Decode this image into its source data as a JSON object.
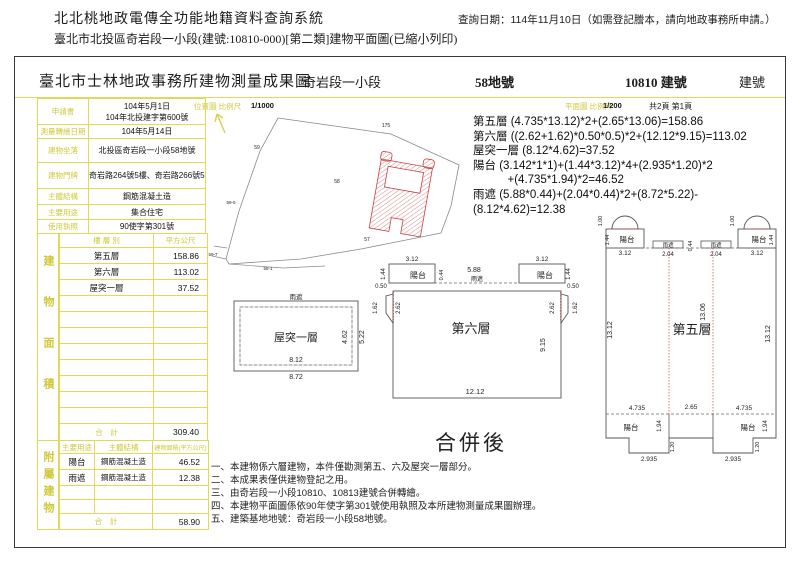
{
  "colors": {
    "accent_yellow": "#e0da5a",
    "label_yellow": "#cfc93a",
    "plan_red": "#c84040",
    "ink": "#1c1c1c"
  },
  "page": {
    "system_title": "北北桃地政電傳全功能地籍資料查詢系統",
    "query_date": "查詢日期：114年11月10日（如需登記謄本，請向地政事務所申請。）",
    "doc_line": "臺北市北投區奇岩段一小段(建號:10810-000)[第二類]建物平面圖(已縮小列印)"
  },
  "sheet": {
    "title": "臺北市士林地政事務所建物測量成果圖",
    "section": "奇岩段一小段",
    "land_no": "58地號",
    "building_no": "10810 建號",
    "building_no2": "建號",
    "scale_map_label": "位置圖 比例尺",
    "scale_map_value": "1/1000",
    "scale_plan_label": "平面圖 比例尺",
    "scale_plan_value": "1/200",
    "page_info": "共2頁 第1頁",
    "north_icon": "north-arrow"
  },
  "info": {
    "rows": [
      {
        "label": "申請書",
        "line1": "104年5月1日",
        "line2": "104年北投建字第600號"
      },
      {
        "label": "測量轉繪日期",
        "value": "104年5月14日"
      },
      {
        "label": "建物坐落",
        "value": "北投區奇岩段一小段58地號"
      },
      {
        "label": "建物門牌",
        "value": "奇岩路264號5樓、奇岩路266號5樓"
      },
      {
        "label": "主體結構",
        "value": "鋼筋混凝土造"
      },
      {
        "label": "主要用途",
        "value": "集合住宅"
      },
      {
        "label": "使用執照",
        "value": "90使字第301號"
      }
    ]
  },
  "area": {
    "side_label": "建物面積",
    "header": [
      "樓 層 別",
      "平方公尺"
    ],
    "rows": [
      [
        "第五層",
        "158.86"
      ],
      [
        "第六層",
        "113.02"
      ],
      [
        "屋突一層",
        "37.52"
      ]
    ],
    "total_label": "合　計",
    "total": "309.40"
  },
  "annex": {
    "side_label": "附屬建物",
    "header": [
      "主要用途",
      "主體結構",
      "建物面積(平方公尺)"
    ],
    "rows": [
      [
        "陽台",
        "鋼筋混凝土造",
        "46.52"
      ],
      [
        "雨遮",
        "鋼筋混凝土造",
        "12.38"
      ]
    ],
    "total_label": "合　計",
    "total": "58.90"
  },
  "formulas": [
    "第五層 (4.735*13.12)*2+(2.65*13.06)=158.86",
    "第六層 ((2.62+1.62)*0.50*0.5)*2+(12.12*9.15)=113.02",
    "屋突一層 (8.12*4.62)=37.52",
    "陽台 (3.142*1*1)+(1.44*3.12)*4+(2.935*1.20)*2",
    "　　　+(4.735*1.94)*2=46.52",
    "雨遮 (5.88*0.44)+(2.04*0.44)*2+(8.72*5.22)-(8.12*4.62)=12.38"
  ],
  "notes": [
    "一、本建物係六層建物，本件僅勘測第五、六及屋突一層部分。",
    "二、本成果表僅供建物登記之用。",
    "三、由奇岩段一小段10810、10813建號合併轉繪。",
    "四、本建物平面圖係依90年使字第301號使用執照及本所建物測量成果圖辦理。",
    "五、建築基地地號：奇岩段一小段58地號。"
  ],
  "merge_label": "合併後",
  "map": {
    "labels": [
      {
        "x": 371,
        "y": 70,
        "t": "175",
        "s": 5
      },
      {
        "x": 242,
        "y": 92,
        "t": "59",
        "s": 5
      },
      {
        "x": 216,
        "y": 147,
        "t": "59-5",
        "s": 4.5
      },
      {
        "x": 198,
        "y": 199,
        "t": "59-7",
        "s": 4.5
      },
      {
        "x": 253,
        "y": 213,
        "t": "58-1",
        "s": 4.5
      },
      {
        "x": 322,
        "y": 126,
        "t": "58",
        "s": 5
      },
      {
        "x": 352,
        "y": 184,
        "t": "57",
        "s": 5
      }
    ]
  },
  "plans": {
    "roof": {
      "labels": [
        {
          "x": 281,
          "y": 242,
          "t": "雨遮",
          "s": 6.5
        },
        {
          "x": 281,
          "y": 284,
          "t": "屋突一層",
          "s": 11
        },
        {
          "x": 281,
          "y": 305,
          "t": "8.12",
          "s": 7
        },
        {
          "x": 281,
          "y": 322,
          "t": "8.72",
          "s": 7
        },
        {
          "x": 332,
          "y": 280,
          "t": "4.62",
          "s": 7,
          "r": -90
        },
        {
          "x": 349,
          "y": 280,
          "t": "5.22",
          "s": 7,
          "r": -90
        }
      ]
    },
    "floor6": {
      "labels": [
        {
          "x": 397,
          "y": 204,
          "t": "3.12",
          "s": 6.5
        },
        {
          "x": 527,
          "y": 204,
          "t": "3.12",
          "s": 6.5
        },
        {
          "x": 403,
          "y": 221,
          "t": "陽台",
          "s": 8
        },
        {
          "x": 530,
          "y": 221,
          "t": "陽台",
          "s": 8
        },
        {
          "x": 370,
          "y": 217,
          "t": "1.44",
          "s": 6,
          "r": -90
        },
        {
          "x": 555,
          "y": 217,
          "t": "1.44",
          "s": 6,
          "r": -90
        },
        {
          "x": 459,
          "y": 215,
          "t": "5.88",
          "s": 7
        },
        {
          "x": 462,
          "y": 224,
          "t": "雨遮",
          "s": 6
        },
        {
          "x": 428,
          "y": 218,
          "t": "0.44",
          "s": 5.5,
          "r": -90
        },
        {
          "x": 366,
          "y": 231,
          "t": "0.50",
          "s": 6
        },
        {
          "x": 558,
          "y": 231,
          "t": "0.50",
          "s": 6
        },
        {
          "x": 362,
          "y": 251,
          "t": "1.62",
          "s": 6,
          "r": -90
        },
        {
          "x": 562,
          "y": 251,
          "t": "1.62",
          "s": 6,
          "r": -90
        },
        {
          "x": 385,
          "y": 251,
          "t": "2.62",
          "s": 6,
          "r": -90
        },
        {
          "x": 539,
          "y": 251,
          "t": "2.62",
          "s": 6,
          "r": -90
        },
        {
          "x": 456,
          "y": 276,
          "t": "第六層",
          "s": 13
        },
        {
          "x": 530,
          "y": 288,
          "t": "9.15",
          "s": 7,
          "r": -90
        },
        {
          "x": 460,
          "y": 337,
          "t": "12.12",
          "s": 7.5
        }
      ]
    },
    "floor5": {
      "labels": [
        {
          "x": 587,
          "y": 164,
          "t": "1.00",
          "s": 5.5,
          "r": -90
        },
        {
          "x": 719,
          "y": 164,
          "t": "1.00",
          "s": 5.5,
          "r": -90
        },
        {
          "x": 612,
          "y": 185,
          "t": "陽台",
          "s": 7.5
        },
        {
          "x": 744,
          "y": 185,
          "t": "陽台",
          "s": 7.5
        },
        {
          "x": 594,
          "y": 183,
          "t": "1.44",
          "s": 5.5,
          "r": -90
        },
        {
          "x": 758,
          "y": 183,
          "t": "1.44",
          "s": 5.5,
          "r": -90
        },
        {
          "x": 610,
          "y": 198,
          "t": "3.12",
          "s": 6.5
        },
        {
          "x": 742,
          "y": 198,
          "t": "3.12",
          "s": 6.5
        },
        {
          "x": 653,
          "y": 190,
          "t": "雨遮",
          "s": 5.5
        },
        {
          "x": 701,
          "y": 190,
          "t": "雨遮",
          "s": 5.5
        },
        {
          "x": 653,
          "y": 199,
          "t": "2.04",
          "s": 6
        },
        {
          "x": 701,
          "y": 199,
          "t": "2.04",
          "s": 6
        },
        {
          "x": 677,
          "y": 189,
          "t": "0.44",
          "s": 5.5,
          "r": -90
        },
        {
          "x": 597,
          "y": 273,
          "t": "13.12",
          "s": 7,
          "r": -90
        },
        {
          "x": 755,
          "y": 277,
          "t": "13.12",
          "s": 7,
          "r": -90
        },
        {
          "x": 690,
          "y": 255,
          "t": "13.06",
          "s": 7,
          "r": -90
        },
        {
          "x": 677,
          "y": 277,
          "t": "第五層",
          "s": 13
        },
        {
          "x": 622,
          "y": 353,
          "t": "4.735",
          "s": 6.5
        },
        {
          "x": 676,
          "y": 352,
          "t": "2.65",
          "s": 6.5
        },
        {
          "x": 729,
          "y": 353,
          "t": "4.735",
          "s": 6.5
        },
        {
          "x": 616,
          "y": 373,
          "t": "陽台",
          "s": 7.5
        },
        {
          "x": 733,
          "y": 373,
          "t": "陽台",
          "s": 7.5
        },
        {
          "x": 646,
          "y": 369,
          "t": "1.94",
          "s": 6,
          "r": -90
        },
        {
          "x": 752,
          "y": 369,
          "t": "1.94",
          "s": 6,
          "r": -90
        },
        {
          "x": 659,
          "y": 390,
          "t": "1.20",
          "s": 5.5,
          "r": -90
        },
        {
          "x": 744,
          "y": 390,
          "t": "1.20",
          "s": 5.5,
          "r": -90
        },
        {
          "x": 634,
          "y": 404,
          "t": "2.935",
          "s": 6.5
        },
        {
          "x": 718,
          "y": 404,
          "t": "2.935",
          "s": 6.5
        }
      ]
    }
  }
}
